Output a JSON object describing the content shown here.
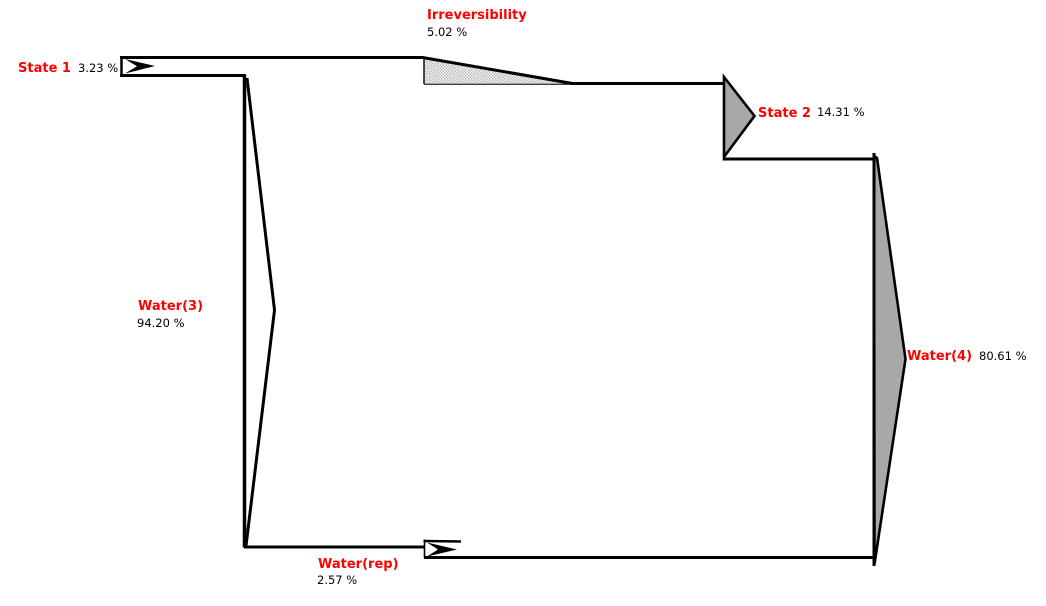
{
  "diagram_title": "Exergy flow (Grassmann) diagram",
  "colors": {
    "label_red": "#ff0000",
    "value_black": "#000000",
    "line_black": "#000000",
    "arrow_fill": "#a8a8a8",
    "hatch": "#b4b4b4",
    "background": "#ffffff"
  },
  "flows": {
    "state1": {
      "label": "State 1",
      "value": "3.23 %"
    },
    "irreversibility": {
      "label": "Irreversibility",
      "value": "5.02 %"
    },
    "state2": {
      "label": "State 2",
      "value": "14.31 %"
    },
    "water3": {
      "label": "Water(3)",
      "value": "94.20 %"
    },
    "water4": {
      "label": "Water(4)",
      "value": "80.61 %"
    },
    "water_rep": {
      "label": "Water(rep)",
      "value": "2.57 %"
    }
  },
  "chart_data": {
    "type": "sankey",
    "unit": "%",
    "inputs": [
      {
        "name": "State 1",
        "percent": 3.23
      },
      {
        "name": "Water(3)",
        "percent": 94.2
      },
      {
        "name": "Water(rep)",
        "percent": 2.57
      }
    ],
    "outputs": [
      {
        "name": "State 2",
        "percent": 14.31
      },
      {
        "name": "Water(4)",
        "percent": 80.61
      },
      {
        "name": "Irreversibility",
        "percent": 5.02
      }
    ],
    "legend": "off",
    "grid": "off"
  }
}
